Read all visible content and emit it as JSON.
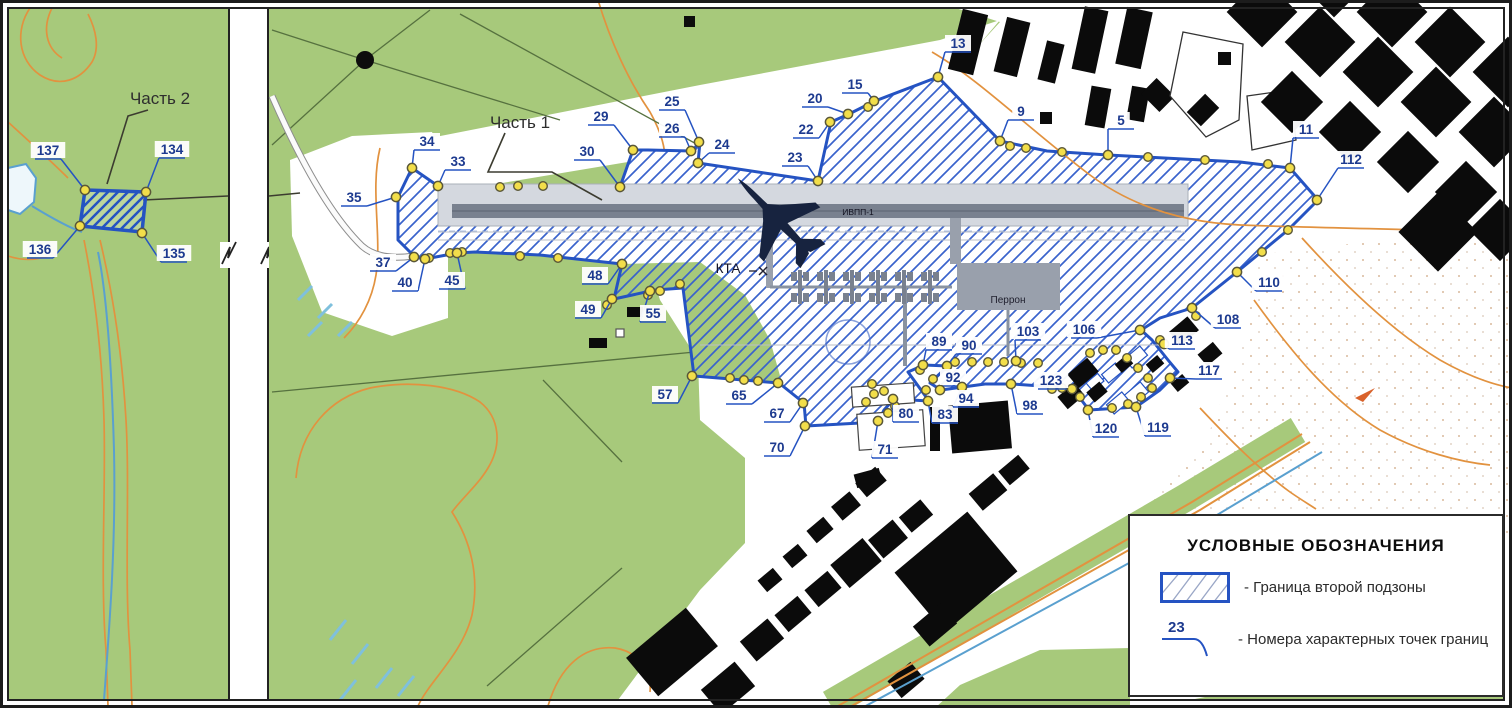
{
  "map_title": "Схема границ второй подзоны приаэродромной территории",
  "part1": {
    "title": "Часть 1",
    "points": [
      {
        "n": "5",
        "lx": 1121,
        "ly": 121,
        "px": 1108,
        "py": 155
      },
      {
        "n": "9",
        "lx": 1021,
        "ly": 112,
        "px": 1000,
        "py": 141
      },
      {
        "n": "11",
        "lx": 1306,
        "ly": 130,
        "px": 1290,
        "py": 168
      },
      {
        "n": "13",
        "lx": 958,
        "ly": 44,
        "px": 938,
        "py": 77
      },
      {
        "n": "15",
        "lx": 855,
        "ly": 85,
        "px": 874,
        "py": 101
      },
      {
        "n": "20",
        "lx": 815,
        "ly": 99,
        "px": 848,
        "py": 114
      },
      {
        "n": "22",
        "lx": 806,
        "ly": 130,
        "px": 830,
        "py": 122
      },
      {
        "n": "23",
        "lx": 795,
        "ly": 158,
        "px": 818,
        "py": 181
      },
      {
        "n": "24",
        "lx": 722,
        "ly": 145,
        "px": 698,
        "py": 163
      },
      {
        "n": "25",
        "lx": 672,
        "ly": 102,
        "px": 699,
        "py": 142
      },
      {
        "n": "26",
        "lx": 672,
        "ly": 129,
        "px": 691,
        "py": 151
      },
      {
        "n": "29",
        "lx": 601,
        "ly": 117,
        "px": 633,
        "py": 150
      },
      {
        "n": "30",
        "lx": 587,
        "ly": 152,
        "px": 620,
        "py": 187
      },
      {
        "n": "33",
        "lx": 458,
        "ly": 162,
        "px": 438,
        "py": 186
      },
      {
        "n": "34",
        "lx": 427,
        "ly": 142,
        "px": 412,
        "py": 168
      },
      {
        "n": "35",
        "lx": 354,
        "ly": 198,
        "px": 396,
        "py": 197
      },
      {
        "n": "37",
        "lx": 383,
        "ly": 263,
        "px": 414,
        "py": 257
      },
      {
        "n": "40",
        "lx": 405,
        "ly": 283,
        "px": 425,
        "py": 259
      },
      {
        "n": "45",
        "lx": 452,
        "ly": 281,
        "px": 457,
        "py": 253
      },
      {
        "n": "48",
        "lx": 595,
        "ly": 276,
        "px": 622,
        "py": 264
      },
      {
        "n": "49",
        "lx": 588,
        "ly": 310,
        "px": 612,
        "py": 299
      },
      {
        "n": "55",
        "lx": 653,
        "ly": 314,
        "px": 650,
        "py": 291
      },
      {
        "n": "57",
        "lx": 665,
        "ly": 395,
        "px": 692,
        "py": 376
      },
      {
        "n": "65",
        "lx": 739,
        "ly": 396,
        "px": 778,
        "py": 383
      },
      {
        "n": "67",
        "lx": 777,
        "ly": 414,
        "px": 803,
        "py": 403
      },
      {
        "n": "70",
        "lx": 777,
        "ly": 448,
        "px": 805,
        "py": 426
      },
      {
        "n": "71",
        "lx": 885,
        "ly": 450,
        "px": 878,
        "py": 421
      },
      {
        "n": "80",
        "lx": 906,
        "ly": 414,
        "px": 893,
        "py": 399
      },
      {
        "n": "83",
        "lx": 945,
        "ly": 415,
        "px": 928,
        "py": 401
      },
      {
        "n": "89",
        "lx": 939,
        "ly": 342,
        "px": 923,
        "py": 365
      },
      {
        "n": "90",
        "lx": 969,
        "ly": 346,
        "px": 947,
        "py": 366
      },
      {
        "n": "92",
        "lx": 953,
        "ly": 378,
        "px": 940,
        "py": 390
      },
      {
        "n": "94",
        "lx": 966,
        "ly": 399,
        "px": 962,
        "py": 387
      },
      {
        "n": "98",
        "lx": 1030,
        "ly": 406,
        "px": 1011,
        "py": 384
      },
      {
        "n": "103",
        "lx": 1028,
        "ly": 332,
        "px": 1016,
        "py": 361
      },
      {
        "n": "106",
        "lx": 1084,
        "ly": 330,
        "px": 1140,
        "py": 330
      },
      {
        "n": "108",
        "lx": 1228,
        "ly": 320,
        "px": 1192,
        "py": 308
      },
      {
        "n": "110",
        "lx": 1269,
        "ly": 283,
        "px": 1237,
        "py": 272
      },
      {
        "n": "112",
        "lx": 1351,
        "ly": 160,
        "px": 1317,
        "py": 200
      },
      {
        "n": "113",
        "lx": 1182,
        "ly": 341,
        "px": 1164,
        "py": 344
      },
      {
        "n": "117",
        "lx": 1209,
        "ly": 371,
        "px": 1170,
        "py": 378
      },
      {
        "n": "119",
        "lx": 1158,
        "ly": 428,
        "px": 1136,
        "py": 407
      },
      {
        "n": "120",
        "lx": 1106,
        "ly": 429,
        "px": 1088,
        "py": 410
      },
      {
        "n": "123",
        "lx": 1051,
        "ly": 381,
        "px": 1072,
        "py": 389
      }
    ]
  },
  "part2": {
    "title": "Часть 2",
    "points": [
      {
        "n": "134",
        "lx": 172,
        "ly": 150,
        "px": 146,
        "py": 192
      },
      {
        "n": "135",
        "lx": 174,
        "ly": 254,
        "px": 142,
        "py": 233
      },
      {
        "n": "136",
        "lx": 40,
        "ly": 250,
        "px": 80,
        "py": 226
      },
      {
        "n": "137",
        "lx": 48,
        "ly": 151,
        "px": 85,
        "py": 190
      }
    ]
  },
  "unlabeled_points": [
    [
      500,
      187
    ],
    [
      518,
      186
    ],
    [
      543,
      186
    ],
    [
      868,
      107
    ],
    [
      1010,
      146
    ],
    [
      1026,
      148
    ],
    [
      1062,
      152
    ],
    [
      1148,
      157
    ],
    [
      1205,
      160
    ],
    [
      1268,
      164
    ],
    [
      1288,
      230
    ],
    [
      1262,
      252
    ],
    [
      429,
      258
    ],
    [
      450,
      253
    ],
    [
      462,
      252
    ],
    [
      520,
      256
    ],
    [
      558,
      258
    ],
    [
      648,
      295
    ],
    [
      660,
      291
    ],
    [
      680,
      284
    ],
    [
      607,
      305
    ],
    [
      730,
      378
    ],
    [
      744,
      380
    ],
    [
      758,
      381
    ],
    [
      872,
      384
    ],
    [
      874,
      394
    ],
    [
      866,
      402
    ],
    [
      884,
      391
    ],
    [
      920,
      370
    ],
    [
      933,
      379
    ],
    [
      955,
      362
    ],
    [
      972,
      362
    ],
    [
      988,
      362
    ],
    [
      1004,
      362
    ],
    [
      1021,
      363
    ],
    [
      1038,
      363
    ],
    [
      1052,
      389
    ],
    [
      1062,
      388
    ],
    [
      926,
      390
    ],
    [
      895,
      406
    ],
    [
      888,
      413
    ],
    [
      1090,
      353
    ],
    [
      1103,
      350
    ],
    [
      1116,
      350
    ],
    [
      1127,
      358
    ],
    [
      1138,
      368
    ],
    [
      1148,
      378
    ],
    [
      1152,
      388
    ],
    [
      1141,
      397
    ],
    [
      1128,
      404
    ],
    [
      1112,
      408
    ],
    [
      1080,
      397
    ],
    [
      1160,
      340
    ],
    [
      1196,
      316
    ]
  ],
  "map_labels": {
    "kta": "КТА",
    "apron": "Перрон",
    "runway": "ИВПП-1"
  },
  "legend": {
    "title": "УСЛОВНЫЕ ОБОЗНАЧЕНИЯ",
    "zone_label": "- Граница второй подзоны",
    "point_symbol": "23",
    "points_label": "- Номера характерных точек границ"
  },
  "colors": {
    "green": "#a7c97b",
    "zone_blue": "#2553c2",
    "hatch_blue": "#3a63cc",
    "point_yellow": "#f2de4a",
    "point_ring": "#5a5738",
    "label_blue": "#1d3a8f",
    "contour_orange": "#e2923f",
    "runway_gray": "#79818f",
    "strip_gray": "#d4d8df",
    "apron_gray": "#99a0ac",
    "building_black": "#0b0b0b",
    "water_blue": "#5aa0cf",
    "plane_navy": "#17233f",
    "field_line": "#56713f",
    "sand_dot": "#c08a5a"
  }
}
